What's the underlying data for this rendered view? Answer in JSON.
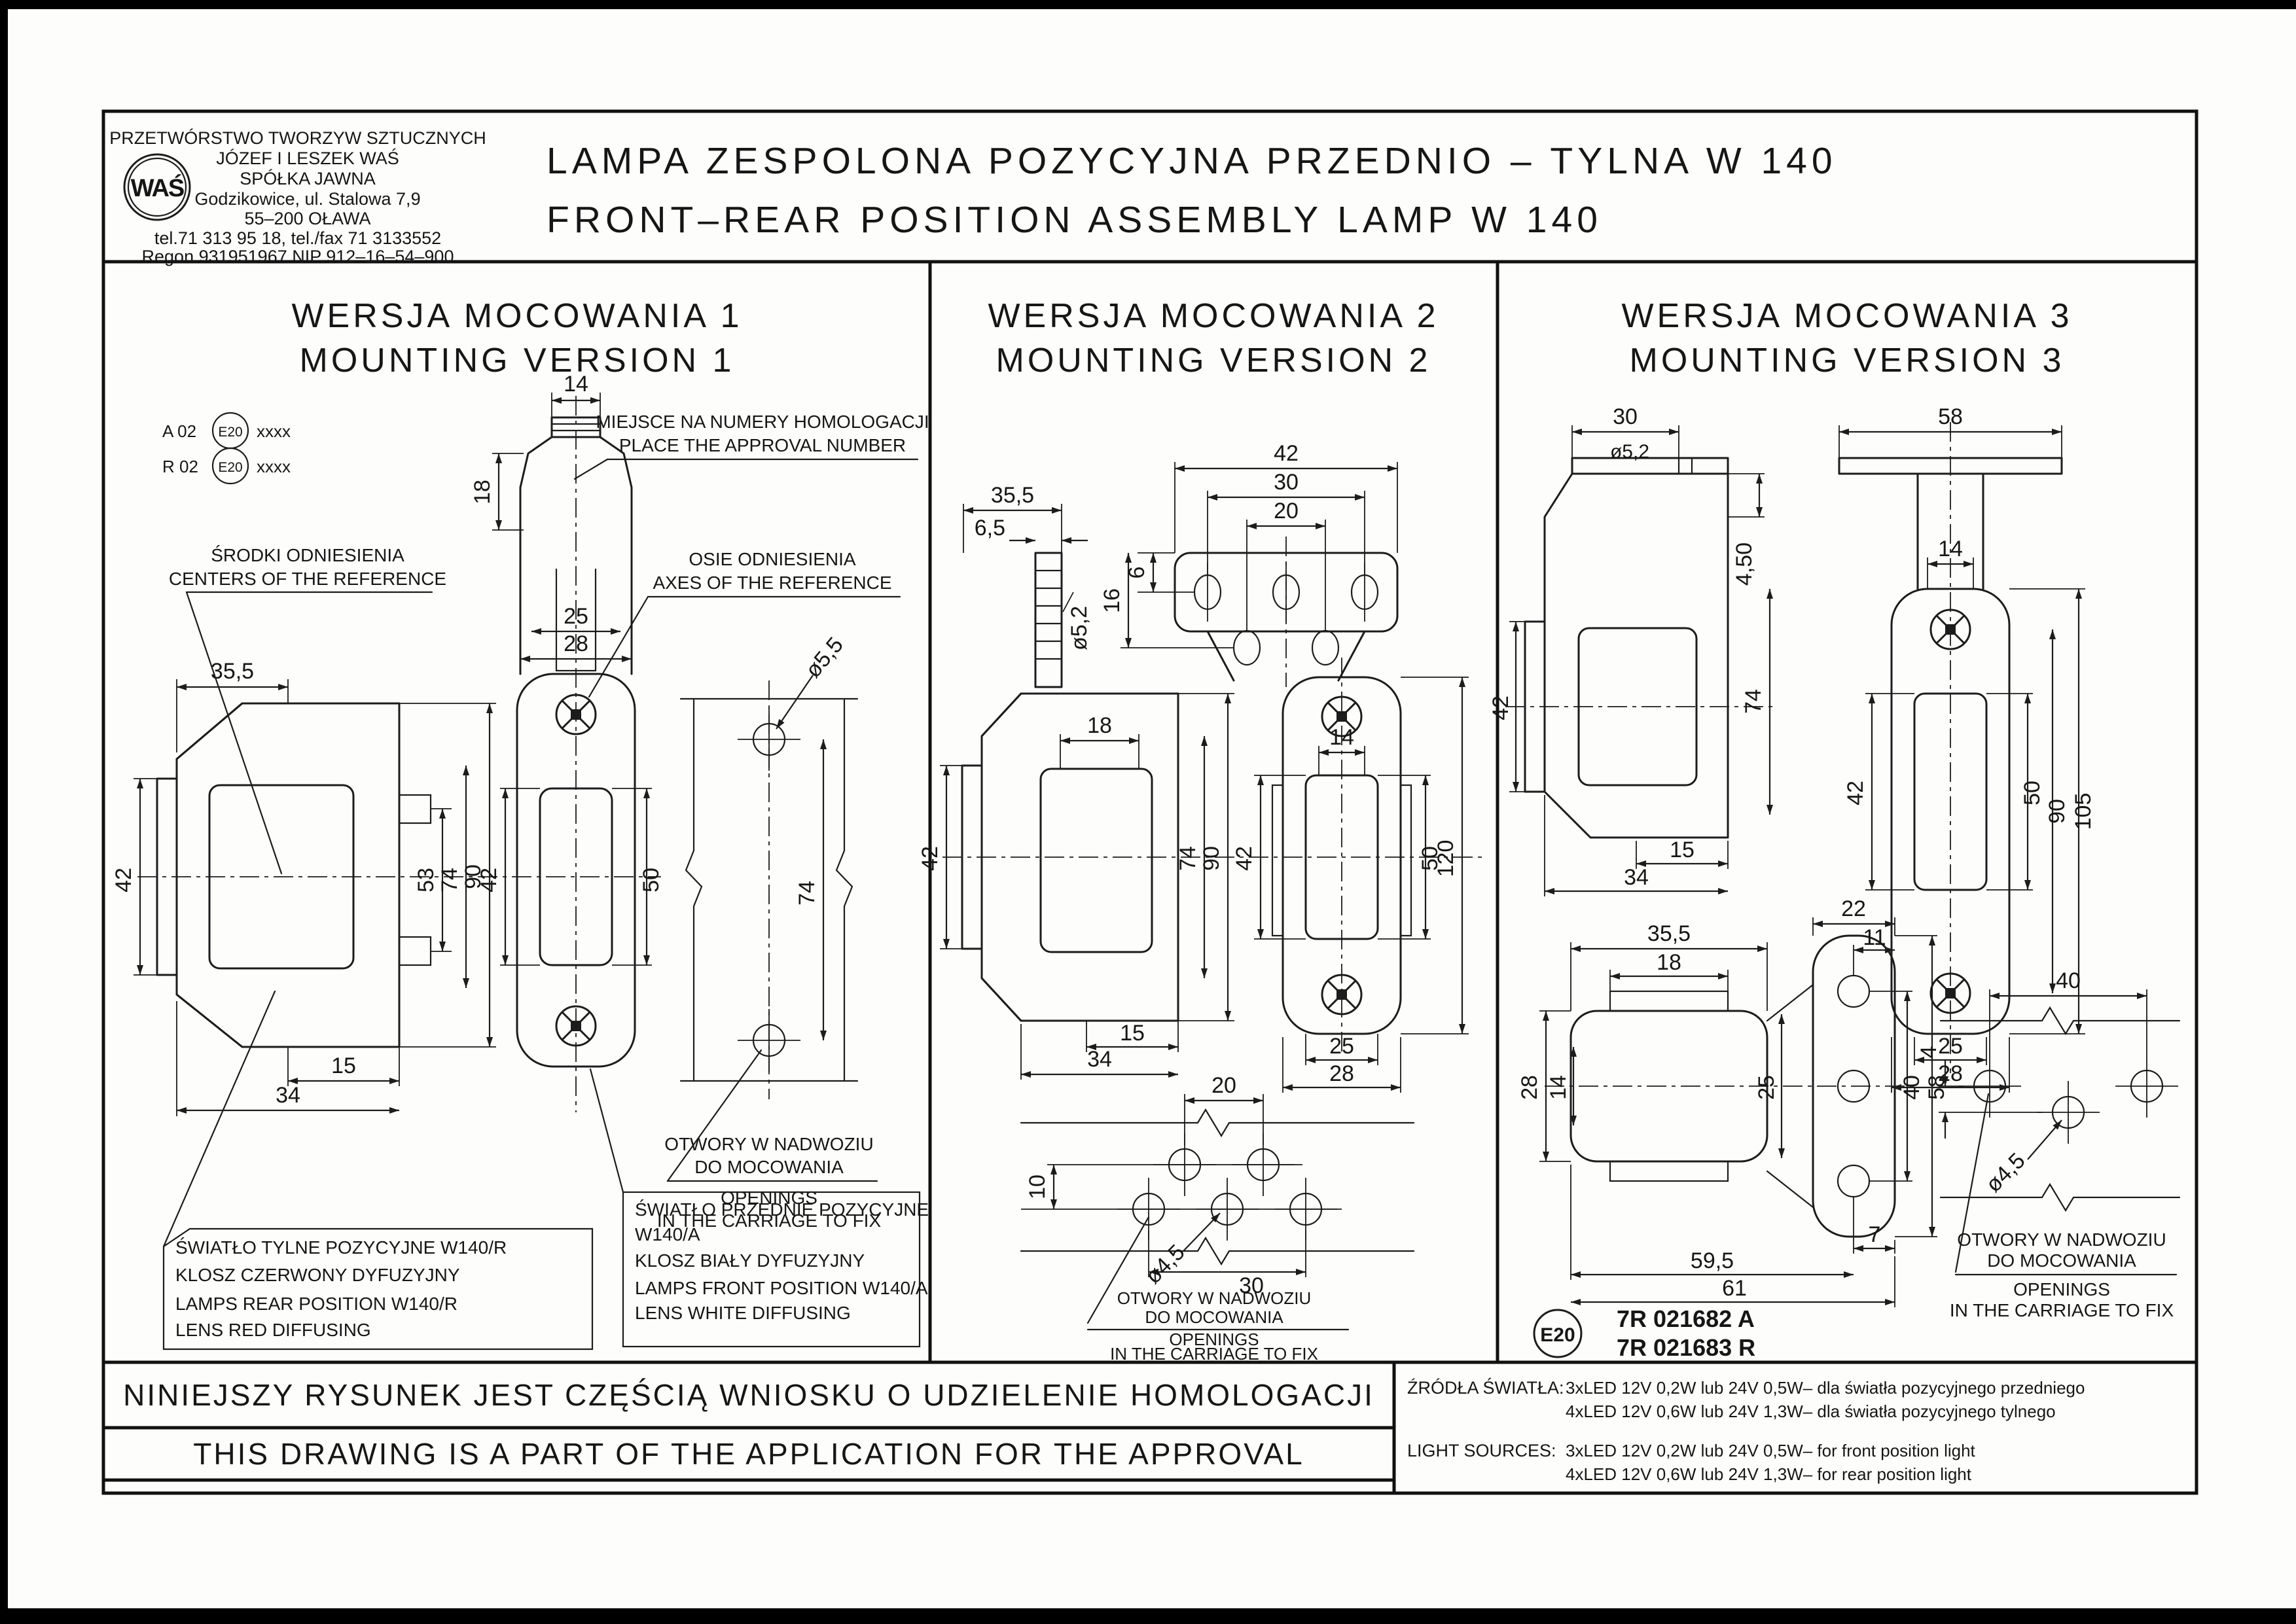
{
  "company": {
    "line1": "PRZETWÓRSTWO TWORZYW SZTUCZNYCH",
    "line2": "JÓZEF I LESZEK WAŚ",
    "line3": "SPÓŁKA JAWNA",
    "line4": "Godzikowice, ul. Stalowa 7,9",
    "line5": "55–200 OŁAWA",
    "line6": "tel.71 313 95 18, tel./fax 71 3133552",
    "line7": "Regon 931951967 NIP 912–16–54–900",
    "logo": "WAŚ"
  },
  "title": {
    "line1": "LAMPA ZESPOLONA POZYCYJNA PRZEDNIO – TYLNA W 140",
    "line2": "FRONT–REAR POSITION ASSEMBLY LAMP W 140"
  },
  "shared": {
    "openings1": "OTWORY W NADWOZIU",
    "openings2": "DO MOCOWANIA",
    "openings3": "OPENINGS",
    "openings4": "IN THE CARRIAGE TO FIX"
  },
  "p1": {
    "h1": "WERSJA MOCOWANIA 1",
    "h2": "MOUNTING VERSION 1",
    "apA": "A 02",
    "apR": "R 02",
    "apE": "E20",
    "apX": "xxxx",
    "homolog1": "MIEJSCE NA NUMERY HOMOLOGACJI",
    "homolog2": "PLACE THE APPROVAL NUMBER",
    "centers1": "ŚRODKI ODNIESIENIA",
    "centers2": "CENTERS OF THE REFERENCE",
    "axes1": "OSIE ODNIESIENIA",
    "axes2": "AXES OF THE REFERENCE",
    "rear1": "ŚWIATŁO TYLNE POZYCYJNE W140/R",
    "rear2": "KLOSZ CZERWONY DYFUZYJNY",
    "rear3": "LAMPS REAR POSITION W140/R",
    "rear4": "LENS RED DIFFUSING",
    "front1": "ŚWIATŁO PRZEDNIE POZYCYJNE",
    "front2": "W140/A",
    "front3": "KLOSZ BIAŁY DYFUZYJNY",
    "front4": "LAMPS FRONT POSITION W140/A",
    "front5": "LENS WHITE DIFFUSING",
    "dims": {
      "14": "14",
      "18": "18",
      "25": "25",
      "28": "28",
      "35,5": "35,5",
      "42": "42",
      "50": "50",
      "53": "53",
      "74": "74",
      "90": "90",
      "15": "15",
      "34": "34",
      "ø5,5": "ø5,5"
    }
  },
  "p2": {
    "h1": "WERSJA MOCOWANIA 2",
    "h2": "MOUNTING VERSION 2",
    "dims": {
      "35,5": "35,5",
      "6,5": "6,5",
      "ø5,2": "ø5,2",
      "42": "42",
      "30": "30",
      "20": "20",
      "6": "6",
      "16": "16",
      "18": "18",
      "74": "74",
      "90": "90",
      "15": "15",
      "34": "34",
      "14": "14",
      "50": "50",
      "120": "120",
      "25": "25",
      "28": "28",
      "10": "10",
      "ø4,5": "ø4,5"
    }
  },
  "p3": {
    "h1": "WERSJA MOCOWANIA 3",
    "h2": "MOUNTING VERSION 3",
    "e20": "E20",
    "app1": "7R 021682 A",
    "app2": "7R 021683 R",
    "dims": {
      "30": "30",
      "ø5,2": "ø5,2",
      "4,50": "4,50",
      "58": "58",
      "14": "14",
      "42": "42",
      "74": "74",
      "15": "15",
      "34": "34",
      "105": "105",
      "90": "90",
      "50": "50",
      "25": "25",
      "28": "28",
      "22": "22",
      "11": "11",
      "35,5": "35,5",
      "18": "18",
      "40": "40",
      "7": "7",
      "59,5": "59,5",
      "61": "61",
      "4": "4",
      "ø4,5": "ø4,5"
    }
  },
  "footer": {
    "pl": "NINIEJSZY RYSUNEK JEST CZĘŚCIĄ WNIOSKU O UDZIELENIE HOMOLOGACJI",
    "en": "THIS DRAWING IS A PART OF THE APPLICATION FOR THE APPROVAL",
    "srcPl": "ŹRÓDŁA ŚWIATŁA:",
    "srcPl1": "3xLED 12V 0,2W lub 24V 0,5W– dla światła pozycyjnego przedniego",
    "srcPl2": "4xLED 12V 0,6W lub 24V 1,3W– dla światła pozycyjnego tylnego",
    "srcEn": "LIGHT SOURCES:",
    "srcEn1": "3xLED 12V 0,2W lub 24V 0,5W– for front position light",
    "srcEn2": "4xLED 12V 0,6W lub 24V 1,3W– for rear position light"
  }
}
